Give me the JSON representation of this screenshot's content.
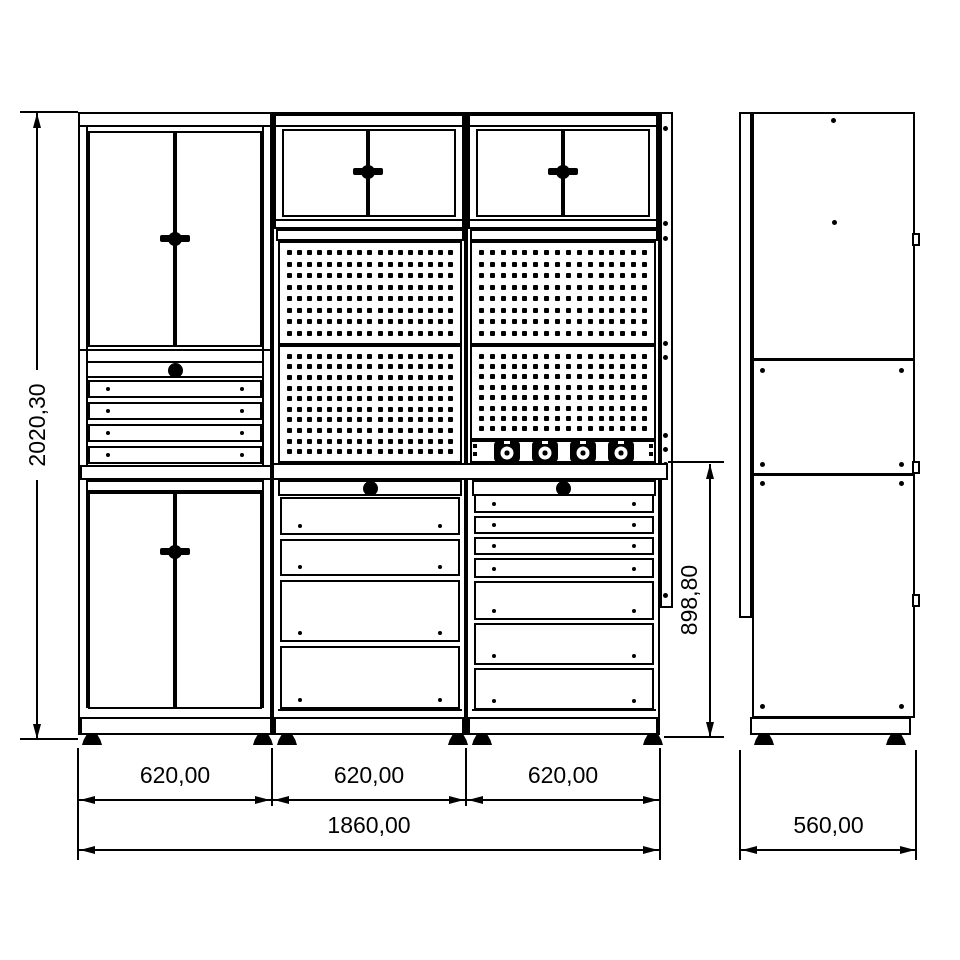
{
  "page": {
    "background": "#ffffff",
    "line_color": "#000000"
  },
  "dimensions": {
    "overall_height": "2020,30",
    "module_widths": [
      "620,00",
      "620,00",
      "620,00"
    ],
    "total_width": "1860,00",
    "depth": "560,00",
    "workbench_section_height": "898,80"
  },
  "front_view": {
    "left_column": {
      "upper_cabinet_doors": 2,
      "drawers": 4,
      "lower_cabinet_doors": 2,
      "lock_knobs": 1
    },
    "middle_column": {
      "wall_cabinet_doors": 2,
      "drawers": 4,
      "lock_knobs": 1
    },
    "right_column": {
      "wall_cabinet_doors": 2,
      "drawers": 7,
      "power_sockets": 4,
      "lock_knobs": 1
    },
    "adjustable_feet": 6
  },
  "pegboard": {
    "panels": [
      {
        "position": "middle-top",
        "cols": 17,
        "rows": 8
      },
      {
        "position": "right-top",
        "cols": 16,
        "rows": 8
      },
      {
        "position": "middle-bottom",
        "cols": 17,
        "rows": 10
      },
      {
        "position": "right-bottom",
        "cols": 16,
        "rows": 8
      }
    ]
  },
  "side_view": {
    "panels": 3,
    "adjustable_feet": 2,
    "door_latches": 3
  }
}
